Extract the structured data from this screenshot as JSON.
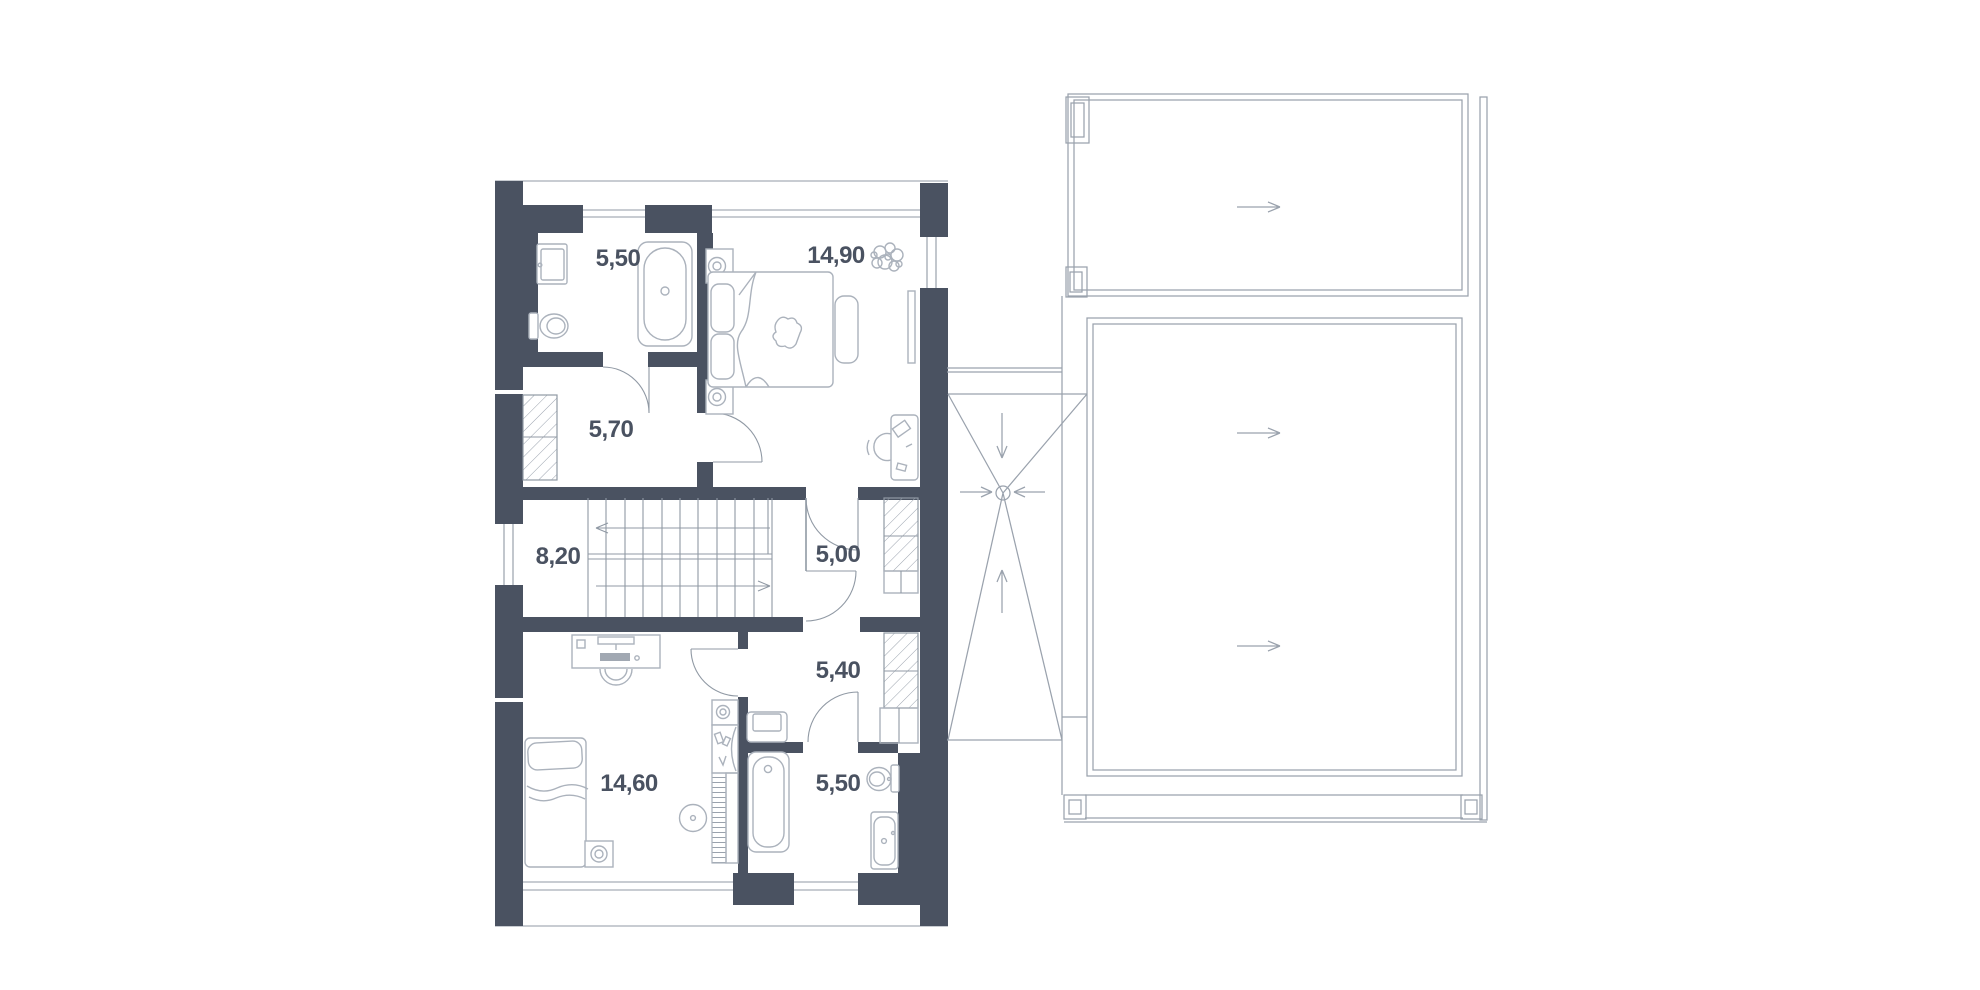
{
  "document": {
    "kind": "floor-plan-drawing"
  },
  "colors": {
    "background": "#ffffff",
    "wall": "#4a5261",
    "line": "#9099a4",
    "furniture": "#abb2bc",
    "hatch": "#9aa2ad",
    "label": "#4a5261"
  },
  "rooms": [
    {
      "id": "bathroom-top",
      "label": "5,50"
    },
    {
      "id": "bedroom-master",
      "label": "14,90"
    },
    {
      "id": "hallway",
      "label": "5,70"
    },
    {
      "id": "staircase",
      "label": "8,20"
    },
    {
      "id": "corridor-upper",
      "label": "5,00"
    },
    {
      "id": "corridor-lower",
      "label": "5,40"
    },
    {
      "id": "bedroom-second",
      "label": "14,60"
    },
    {
      "id": "bathroom-bottom",
      "label": "5,50"
    }
  ],
  "symbols": {
    "stair_up_arrow_direction": "left",
    "stair_down_arrow_direction": "right",
    "roof_slope_arrow_directions": [
      "right",
      "right",
      "right"
    ],
    "terrace_drain_arrow_directions": [
      "down",
      "right",
      "left",
      "up"
    ],
    "terrace_drain": "circle-drain"
  }
}
